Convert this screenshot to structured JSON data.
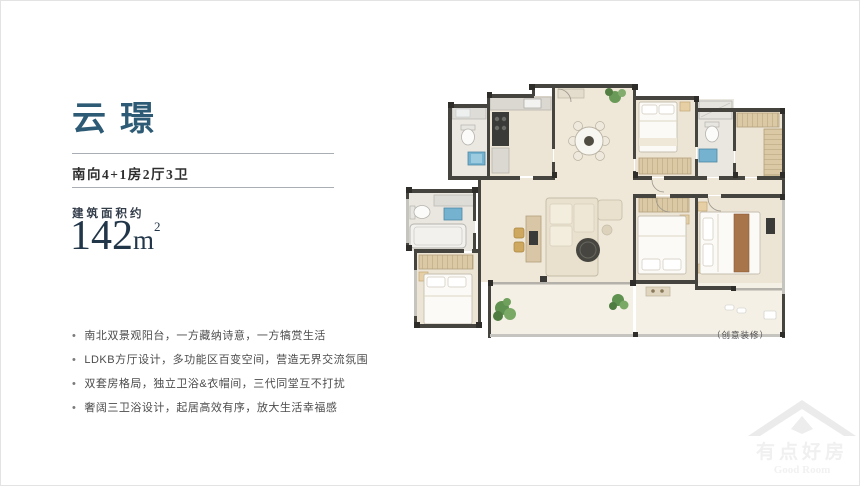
{
  "page": {
    "title": "云璟",
    "subtitle": "南向4+1房2厅3卫",
    "area": {
      "label": "建筑面积约",
      "value": "142",
      "unit": "m",
      "power": "2"
    },
    "bullet": "•",
    "features": [
      "南北双景观阳台，一方藏纳诗意，一方犒赏生活",
      "LDKB方厅设计，多功能区百变空间，营造无界交流氛围",
      "双套房格局，独立卫浴&衣帽间，三代同堂互不打扰",
      "奢阔三卫浴设计，起居高效有序，放大生活幸福感"
    ],
    "plan_caption": "（创意装修）",
    "watermark": {
      "cn": "有点好房",
      "en": "Good Room"
    }
  },
  "colors": {
    "title_teal": "#2d5a74",
    "area_navy": "#223649",
    "text_dark": "#2e2e2e",
    "text_gray": "#4c4c4c",
    "divider": "#a9aeb4",
    "plan_wall": "#45443e",
    "plan_floor": "#ece4d4",
    "plan_fixture_blue": "#74b2d0",
    "plan_wood_gold": "#cfa85f",
    "plan_plant_green": "#5f9150",
    "plan_bed_brown": "#a8744a"
  }
}
